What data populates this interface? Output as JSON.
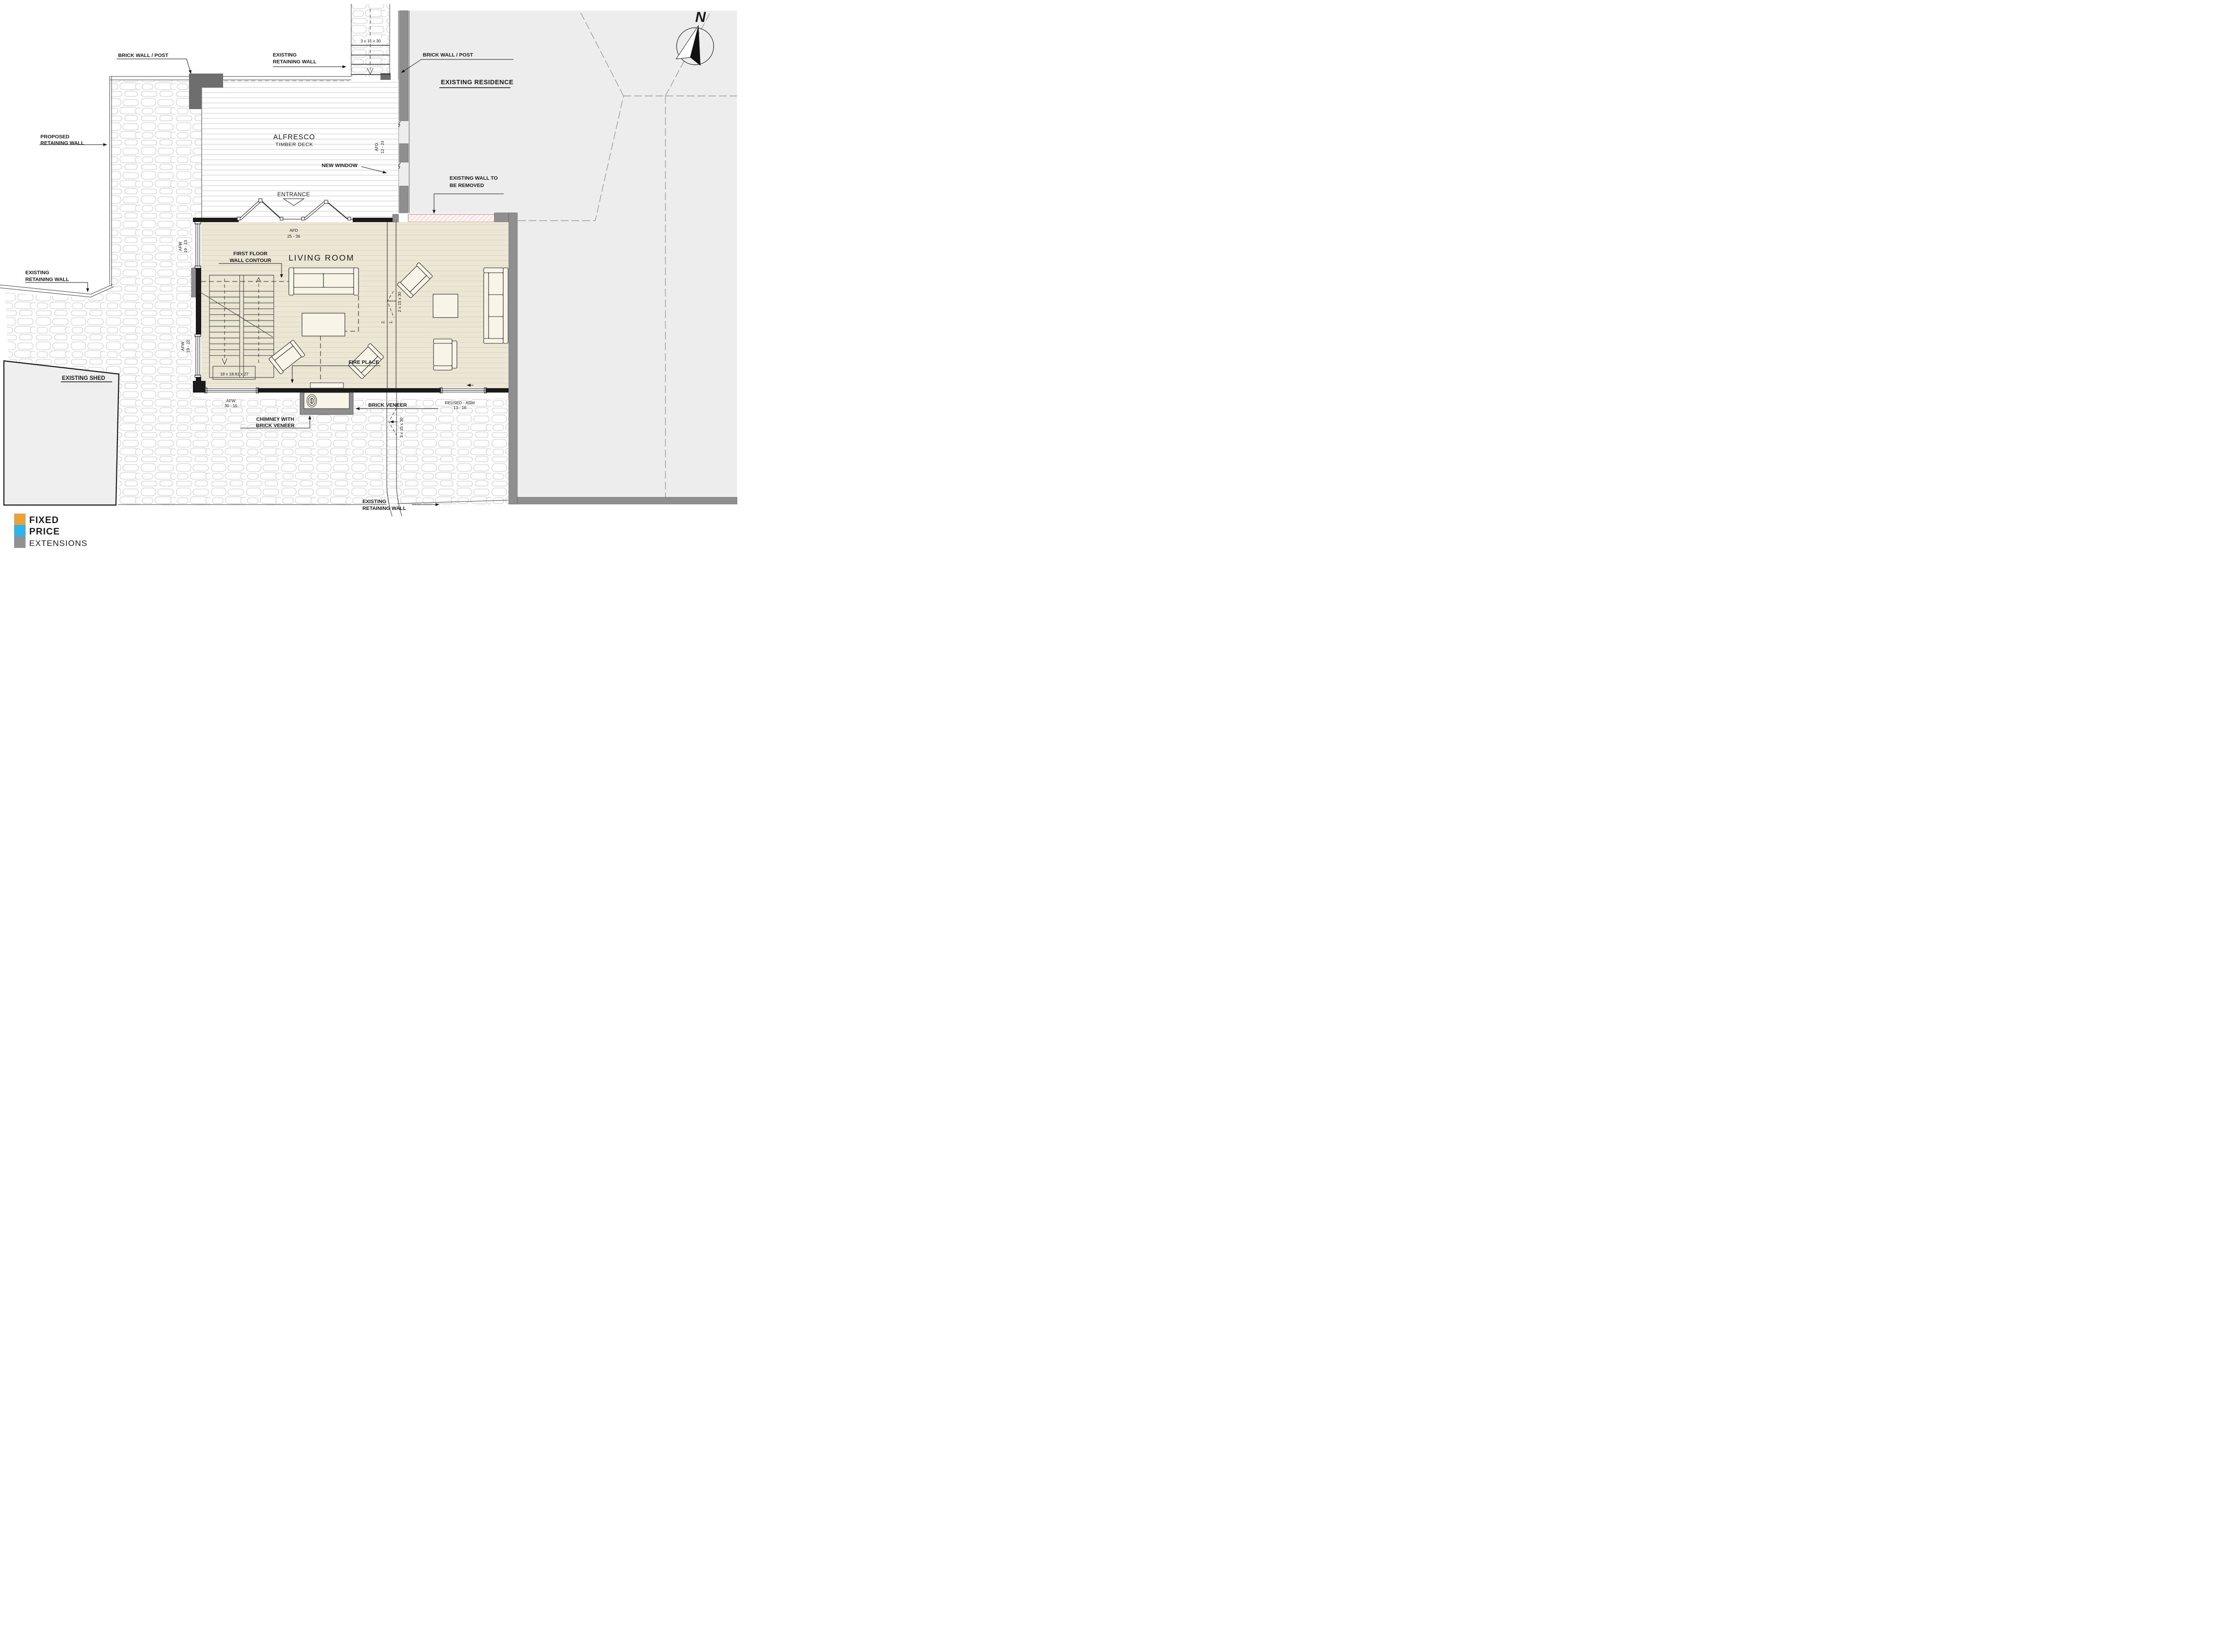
{
  "labels": {
    "brickPostLeft": {
      "text": "BRICK WALL / POST"
    },
    "retainTop": {
      "l1": "EXISTING",
      "l2": "RETAINING WALL"
    },
    "stepsTop": {
      "text": "3 x 15 x 30"
    },
    "brickPostRight": {
      "text": "BRICK WALL / POST"
    },
    "residence": {
      "text": "EXISTING RESIDENCE"
    },
    "proposed": {
      "l1": "PROPOSED",
      "l2": "RETAINING WALL"
    },
    "alfresco": {
      "l1": "ALFRESCO",
      "l2": "TIMBER DECK"
    },
    "afd1224": {
      "l1": "AFD",
      "l2": "12 - 24"
    },
    "newWindow": {
      "text": "NEW WINDOW"
    },
    "removed": {
      "l1": "EXISTING WALL TO",
      "l2": "BE REMOVED"
    },
    "entrance": {
      "text": "ENTRANCE"
    },
    "afd2536": {
      "l1": "AFD",
      "l2": "25 - 36"
    },
    "firstFloor": {
      "l1": "FIRST FLOOR",
      "l2": "WALL CONTOUR"
    },
    "livingRoom": {
      "text": "LIVING ROOM"
    },
    "afw1913": {
      "l1": "AFW",
      "l2": "19 - 13"
    },
    "retainLeft": {
      "l1": "EXISTING",
      "l2": "RETAINING WALL"
    },
    "afw1922": {
      "l1": "AFW",
      "l2": "19 - 22"
    },
    "shed": {
      "text": "EXISTING SHED"
    },
    "stair": {
      "text": "18 x 18.61 x 27"
    },
    "firePlace": {
      "text": "FIRE PLACE"
    },
    "indoorSteps": {
      "text": "2 x 15 x 30",
      "s1": "1.",
      "s2": "2."
    },
    "afw3015": {
      "l1": "AFW",
      "l2": "30 - 15"
    },
    "chimney": {
      "l1": "CHIMNEY WITH",
      "l2": "BRICK VENEER"
    },
    "brickVeneer": {
      "text": "BRICK VENEER"
    },
    "reused": {
      "l1": "REUSED - ASW",
      "l2": "13 - 16"
    },
    "stepsBottom": {
      "text": "3 x 15 x 30"
    },
    "retainBottom": {
      "l1": "EXISTING",
      "l2": "RETAINING WALL"
    },
    "north": {
      "text": "N"
    }
  },
  "logo": {
    "l1": "FIXED",
    "l2": "PRICE",
    "l3": "EXTENSIONS",
    "c1": "#E9A13B",
    "c2": "#2FB3E8",
    "c3": "#8F9193"
  },
  "colors": {
    "floor": "#EBE7D4",
    "residence": "#EDEDED",
    "shed": "#EFEFEF",
    "removedFill": "#FDF5F3",
    "removedOutline": "#C98982",
    "wallGray": "#8F8F8F",
    "wallBlack": "#1A1A1A",
    "stoneLine": "#C8C8C8",
    "furniture": "#F8F5E8"
  }
}
